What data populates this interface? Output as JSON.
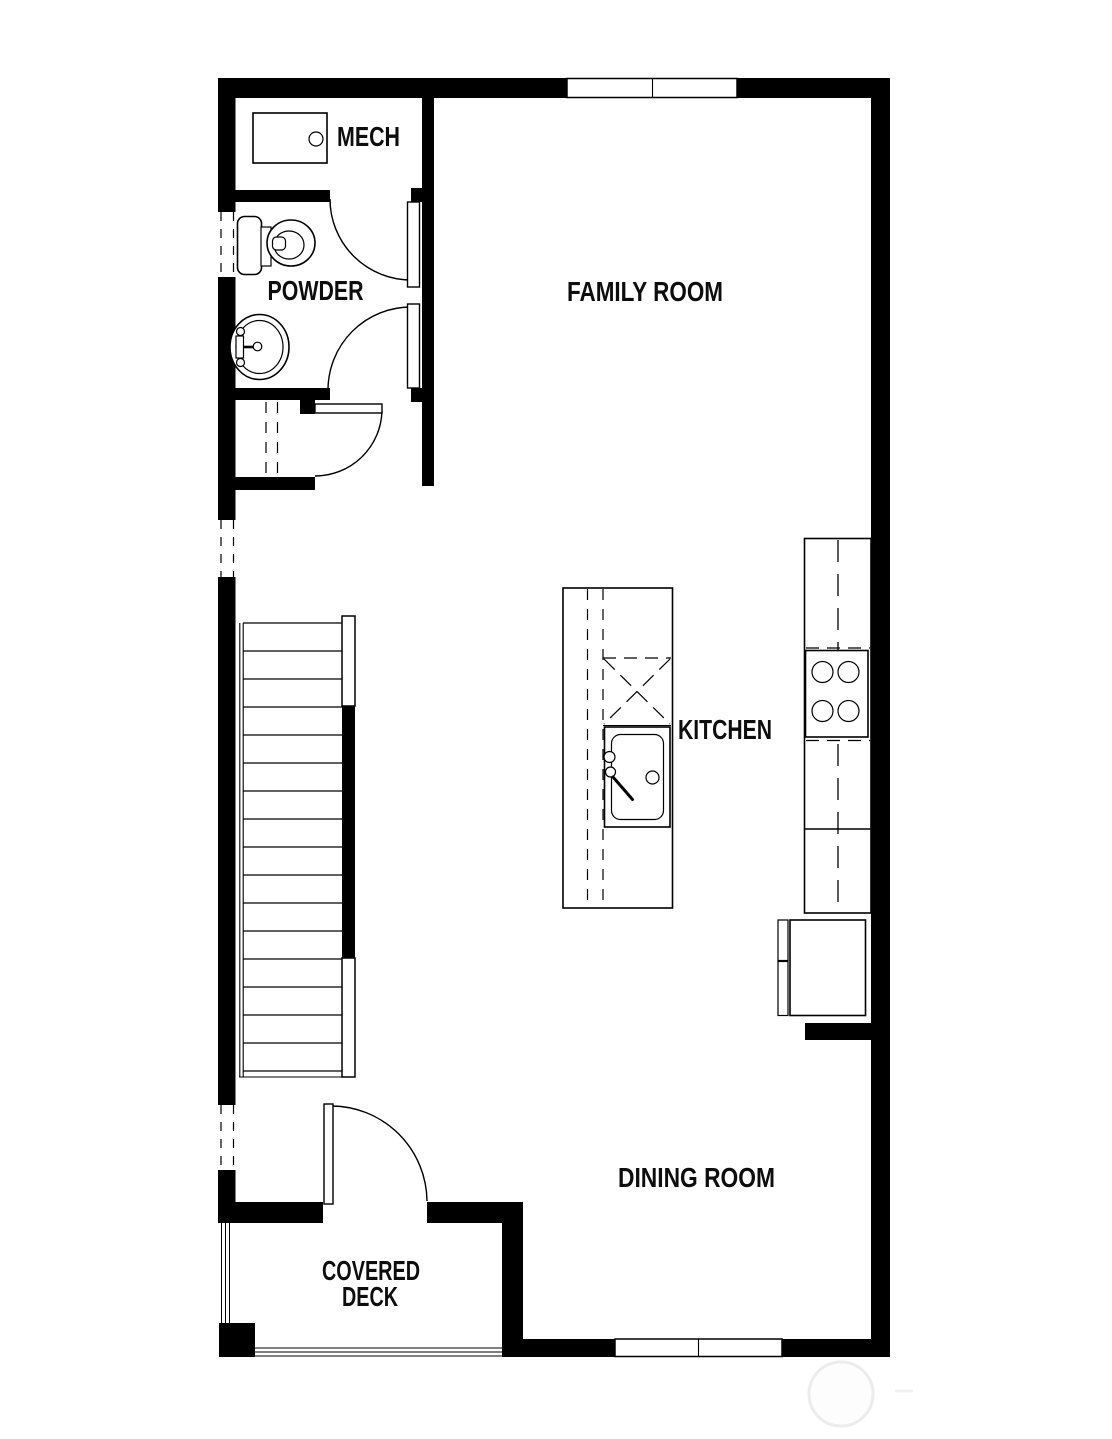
{
  "page": {
    "background": "#ffffff",
    "wall_color": "#000000",
    "line_color": "#000000",
    "text_color": "#0d0d0d",
    "watermark_color": "#ececec"
  },
  "plan": {
    "type": "floor-plan",
    "labels": {
      "mech": "MECH",
      "powder": "POWDER",
      "family_room": "FAMILY ROOM",
      "kitchen": "KITCHEN",
      "dining_room": "DINING ROOM",
      "covered_deck_line1": "COVERED",
      "covered_deck_line2": "DECK"
    },
    "rooms": [
      {
        "id": "mech",
        "label": "MECH"
      },
      {
        "id": "powder",
        "label": "POWDER"
      },
      {
        "id": "family-room",
        "label": "FAMILY ROOM"
      },
      {
        "id": "kitchen",
        "label": "KITCHEN"
      },
      {
        "id": "dining-room",
        "label": "DINING ROOM"
      },
      {
        "id": "covered-deck",
        "label": "COVERED DECK"
      }
    ],
    "fixtures": [
      "mech-equipment",
      "toilet",
      "powder-sink",
      "under-stair-closet",
      "stairs",
      "kitchen-island",
      "dishwasher",
      "kitchen-sink",
      "range-stove",
      "refrigerator",
      "deck-railing"
    ]
  }
}
